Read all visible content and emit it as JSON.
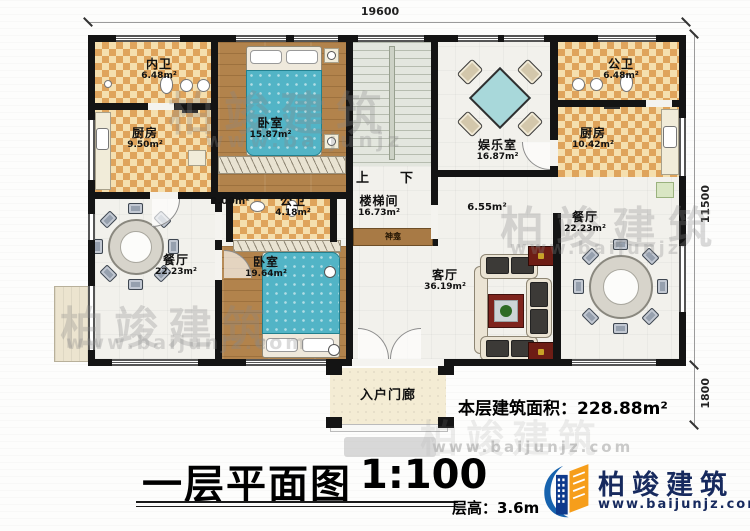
{
  "plan": {
    "rooms": [
      {
        "name": "内卫",
        "area": "6.48m²"
      },
      {
        "name": "厨房",
        "area": "9.50m²"
      },
      {
        "name": "卧室",
        "area": "15.87m²"
      },
      {
        "name": "公卫",
        "area": "4.18m²"
      },
      {
        "name": "楼梯间",
        "area": "16.73m²"
      },
      {
        "name": "娱乐室",
        "area": "16.87m²"
      },
      {
        "name": "公卫",
        "area": "6.48m²"
      },
      {
        "name": "厨房",
        "area": "10.42m²"
      },
      {
        "name": "餐厅",
        "area": "22.23m²"
      },
      {
        "name": "卧室",
        "area": "19.64m²"
      },
      {
        "name": "客厅",
        "area": "36.19m²"
      },
      {
        "name": "餐厅",
        "area": "22.23m²"
      }
    ],
    "porch": {
      "name": "入户门廊"
    },
    "small_areas": {
      "corridor_left": "2.00m²",
      "corridor_right": "6.55m²"
    },
    "stairs": {
      "up": "上",
      "down": "下"
    },
    "shrine": "神龛",
    "dimensions": {
      "width": "19600",
      "height_main": "11500",
      "height_porch": "1800"
    }
  },
  "summary": {
    "label": "本层建筑面积：",
    "value": "228.88m²"
  },
  "titleblock": {
    "title": "一层平面图",
    "scale": "1:100",
    "floor_height_label": "层高：",
    "floor_height_value": "3.6m"
  },
  "brand": {
    "name": "柏竣建筑",
    "site": "www.baijunjz.com"
  },
  "watermark": {
    "name": "柏竣建筑",
    "site": "www.baijunjz.com",
    "site_short": "www.baijunjz"
  }
}
